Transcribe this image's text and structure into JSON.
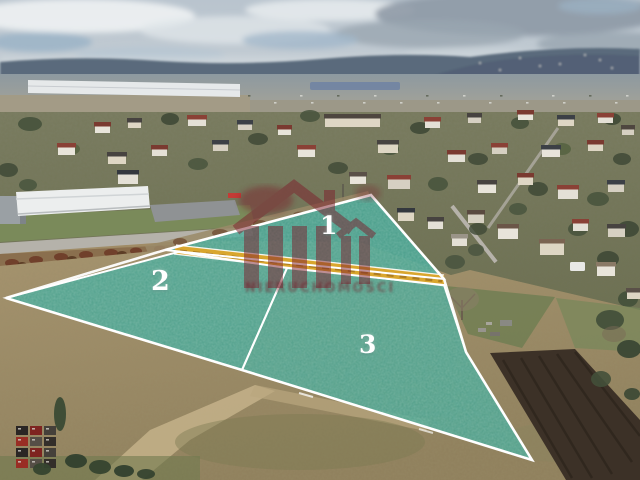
{
  "photo": {
    "kind": "aerial-drone-photo-of-land-parcels"
  },
  "plots": [
    {
      "label": "1"
    },
    {
      "label": "2"
    },
    {
      "label": "3"
    }
  ],
  "watermark": {
    "text": "NIERUCHOMOŚCI"
  },
  "colors": {
    "plot_overlay": "#3fa795",
    "plot_border": "#ffffff",
    "road_overlay": "#d9a62e",
    "plot_number": "#ffffff",
    "watermark_red": "#7d1f2c"
  }
}
